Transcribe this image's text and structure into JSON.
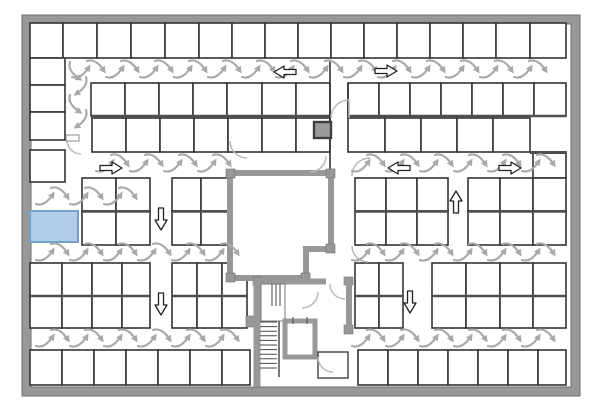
{
  "plan": {
    "canvas": {
      "w": 600,
      "h": 420,
      "bg": "#ffffff"
    },
    "colors": {
      "wall_fill": "#989898",
      "wall_edge": "#6e6e6e",
      "stall_line": "#333333",
      "bank_line": "#4f4f4f",
      "sweep": "#a9a9a9",
      "door": "#b9b9b9",
      "arrow_fill": "#ffffff",
      "arrow_stroke": "#222222",
      "highlight_fill": "#aec9e8",
      "highlight_edge": "#779fcb",
      "shaft_fill": "#9a9a9a",
      "shaft_edge": "#3f3f3f"
    },
    "outer_wall": {
      "x": 22,
      "y": 15,
      "w": 558,
      "h": 381,
      "t": 9
    },
    "stall_line_w": 1.6,
    "rows_h": [
      {
        "name": "row-top",
        "y": 23,
        "h": 35,
        "segs": [
          [
            30,
            63,
            97,
            131,
            165,
            199,
            232,
            265,
            298,
            331,
            364,
            397,
            430,
            463,
            496,
            530,
            566
          ]
        ]
      },
      {
        "name": "row-b",
        "y": 83,
        "h": 33,
        "segs": [
          [
            91,
            125,
            159,
            193,
            227,
            262,
            296,
            330
          ],
          [
            348,
            379,
            410,
            441,
            472,
            503,
            534,
            566
          ]
        ]
      },
      {
        "name": "row-c",
        "y": 118,
        "h": 34,
        "segs": [
          [
            92,
            126,
            160,
            194,
            228,
            262,
            296,
            330
          ],
          [
            348,
            385,
            421,
            457,
            493,
            530
          ]
        ]
      },
      {
        "name": "row-d",
        "y": 178,
        "h": 33,
        "segs": [
          [
            82,
            116,
            150
          ],
          [
            172,
            201,
            230
          ],
          [
            355,
            386,
            417,
            448
          ],
          [
            468,
            500,
            533
          ]
        ]
      },
      {
        "name": "row-e",
        "y": 211,
        "h": 34,
        "segs": [
          [
            82,
            116,
            150
          ],
          [
            172,
            201,
            230
          ],
          [
            355,
            386,
            417,
            448
          ],
          [
            468,
            500,
            533
          ]
        ]
      },
      {
        "name": "row-f",
        "y": 263,
        "h": 33,
        "segs": [
          [
            30,
            62,
            92,
            122,
            150
          ],
          [
            172,
            197,
            222,
            247
          ],
          [
            355,
            379,
            403
          ],
          [
            432,
            466,
            500,
            533,
            566
          ]
        ]
      },
      {
        "name": "row-g",
        "y": 296,
        "h": 32,
        "segs": [
          [
            30,
            62,
            92,
            122,
            150
          ],
          [
            172,
            197,
            222,
            247
          ],
          [
            355,
            379,
            403
          ],
          [
            432,
            466,
            500,
            533,
            566
          ]
        ]
      },
      {
        "name": "row-bottom",
        "y": 350,
        "h": 35,
        "segs": [
          [
            30,
            62,
            94,
            126,
            158,
            190,
            222,
            250
          ],
          [
            358,
            388,
            418,
            448,
            478,
            508,
            538,
            566
          ]
        ]
      }
    ],
    "rows_v": [
      {
        "name": "left-column",
        "x": 30,
        "w": 35,
        "ydiv": [
          58,
          85,
          112,
          140
        ]
      },
      {
        "name": "left-column-2",
        "x": 30,
        "w": 35,
        "ydiv": [
          150,
          182
        ]
      },
      {
        "name": "right-column",
        "x": 533,
        "w": 33,
        "ydiv": [
          152,
          178,
          211,
          245
        ]
      }
    ],
    "bank_lines": [
      {
        "x1": 91,
        "y1": 116,
        "x2": 330,
        "y2": 116,
        "w": 2.6
      },
      {
        "x1": 348,
        "y1": 116,
        "x2": 566,
        "y2": 116,
        "w": 2.6
      },
      {
        "x1": 82,
        "y1": 211.5,
        "x2": 150,
        "y2": 211.5,
        "w": 2.6
      },
      {
        "x1": 172,
        "y1": 211.5,
        "x2": 230,
        "y2": 211.5,
        "w": 2.6
      },
      {
        "x1": 355,
        "y1": 211.5,
        "x2": 448,
        "y2": 211.5,
        "w": 2.6
      },
      {
        "x1": 468,
        "y1": 211.5,
        "x2": 566,
        "y2": 211.5,
        "w": 2.6
      },
      {
        "x1": 30,
        "y1": 296,
        "x2": 150,
        "y2": 296,
        "w": 2.6
      },
      {
        "x1": 172,
        "y1": 296,
        "x2": 247,
        "y2": 296,
        "w": 2.6
      },
      {
        "x1": 355,
        "y1": 296,
        "x2": 403,
        "y2": 296,
        "w": 2.6
      },
      {
        "x1": 432,
        "y1": 296,
        "x2": 566,
        "y2": 296,
        "w": 2.6
      },
      {
        "x1": 530,
        "y1": 152.5,
        "x2": 566,
        "y2": 152.5,
        "w": 3
      }
    ],
    "struct_lines": [
      {
        "x1": 330,
        "y1": 60,
        "x2": 330,
        "y2": 173
      },
      {
        "x1": 348,
        "y1": 83,
        "x2": 348,
        "y2": 118
      }
    ],
    "core": {
      "path": "M230,173 L331,173 L331,249 L306,249 L306,278 L230,278 Z",
      "t": 6
    },
    "core_tabs": [
      {
        "x": 226,
        "y": 169,
        "w": 9,
        "h": 9
      },
      {
        "x": 326,
        "y": 169,
        "w": 9,
        "h": 9
      },
      {
        "x": 326,
        "y": 244,
        "w": 9,
        "h": 9
      },
      {
        "x": 226,
        "y": 273,
        "w": 9,
        "h": 9
      },
      {
        "x": 301,
        "y": 273,
        "w": 9,
        "h": 9
      },
      {
        "x": 253,
        "y": 277,
        "w": 8,
        "h": 8
      },
      {
        "x": 344,
        "y": 277,
        "w": 9,
        "h": 8
      },
      {
        "x": 246,
        "y": 316,
        "w": 8,
        "h": 11
      },
      {
        "x": 344,
        "y": 325,
        "w": 9,
        "h": 9
      }
    ],
    "stair_walls": [
      {
        "x1": 257,
        "y1": 280,
        "x2": 257,
        "y2": 387,
        "w": 7
      },
      {
        "x1": 253,
        "y1": 281.5,
        "x2": 326,
        "y2": 281.5,
        "w": 6
      },
      {
        "x1": 344,
        "y1": 281.5,
        "x2": 352,
        "y2": 281.5,
        "w": 6
      },
      {
        "x1": 349,
        "y1": 281,
        "x2": 349,
        "y2": 332,
        "w": 6
      }
    ],
    "elevator": {
      "x": 285,
      "y": 321,
      "w": 30,
      "h": 36,
      "t": 5
    },
    "elevator_door_marks": [
      {
        "x1": 293,
        "y1": 317,
        "x2": 293,
        "y2": 324
      },
      {
        "x1": 307,
        "y1": 317,
        "x2": 307,
        "y2": 324
      }
    ],
    "stairs": {
      "x0": 260,
      "x1": 277,
      "y": 322,
      "step": 4.6,
      "count": 11,
      "rail_x": 279,
      "rail_y0": 321,
      "rail_y1": 377,
      "up_marks": {
        "xs": [
          272,
          276,
          280
        ],
        "y0": 284,
        "y1": 306
      }
    },
    "stair_room": {
      "x": 261,
      "y": 284,
      "w": 24,
      "h": 37
    },
    "small_room": {
      "x": 318,
      "y": 352,
      "w": 30,
      "h": 26
    },
    "shaft_box": {
      "x": 314,
      "y": 122,
      "w": 17,
      "h": 16
    },
    "doors": [
      {
        "d": "M331,118 A18,18 0 0 1 349,100"
      },
      {
        "d": "M349,100 L349,118"
      },
      {
        "d": "M352,176 A18,18 0 0 1 370,158"
      },
      {
        "d": "M352,246 A16,16 0 0 0 368,262"
      },
      {
        "d": "M310,172 A16,16 0 0 0 326,156"
      },
      {
        "d": "M230,141 A17,17 0 0 0 247,158"
      },
      {
        "d": "M67,140 A14,14 0 0 0 81,154"
      },
      {
        "d": "M318,292 A16,16 0 0 1 302,308"
      },
      {
        "d": "M330,284 A15,15 0 0 0 345,299"
      },
      {
        "d": "M318,357 A15,15 0 0 0 333,372"
      }
    ],
    "door_leaf": {
      "x": 66,
      "y": 135,
      "w": 13,
      "h": 6
    },
    "sweep_aisles_h": [
      {
        "y": 69,
        "x0": 72,
        "x1": 556,
        "step": 34
      },
      {
        "y": 163,
        "x0": 96,
        "x1": 230,
        "step": 34
      },
      {
        "y": 163,
        "x0": 352,
        "x1": 556,
        "step": 34
      },
      {
        "y": 196,
        "x0": 36,
        "x1": 148,
        "step": 34
      },
      {
        "y": 252,
        "x0": 36,
        "x1": 250,
        "step": 34
      },
      {
        "y": 252,
        "x0": 352,
        "x1": 556,
        "step": 34
      },
      {
        "y": 338,
        "x0": 36,
        "x1": 250,
        "step": 34
      },
      {
        "y": 338,
        "x0": 352,
        "x1": 556,
        "step": 34
      }
    ],
    "sweep_aisles_v": [
      {
        "x": 74,
        "y0": 62,
        "y1": 158,
        "step": 33
      }
    ],
    "flow_arrows": [
      {
        "x": 285,
        "y": 72,
        "dir": "left"
      },
      {
        "x": 386,
        "y": 71,
        "dir": "right"
      },
      {
        "x": 111,
        "y": 168,
        "dir": "right"
      },
      {
        "x": 399,
        "y": 168,
        "dir": "left"
      },
      {
        "x": 510,
        "y": 168,
        "dir": "right"
      },
      {
        "x": 161,
        "y": 219,
        "dir": "down"
      },
      {
        "x": 161,
        "y": 304,
        "dir": "down"
      },
      {
        "x": 456,
        "y": 202,
        "dir": "up"
      },
      {
        "x": 410,
        "y": 302,
        "dir": "down"
      }
    ],
    "highlight_stall": {
      "x": 30,
      "y": 211,
      "w": 48,
      "h": 31
    }
  }
}
